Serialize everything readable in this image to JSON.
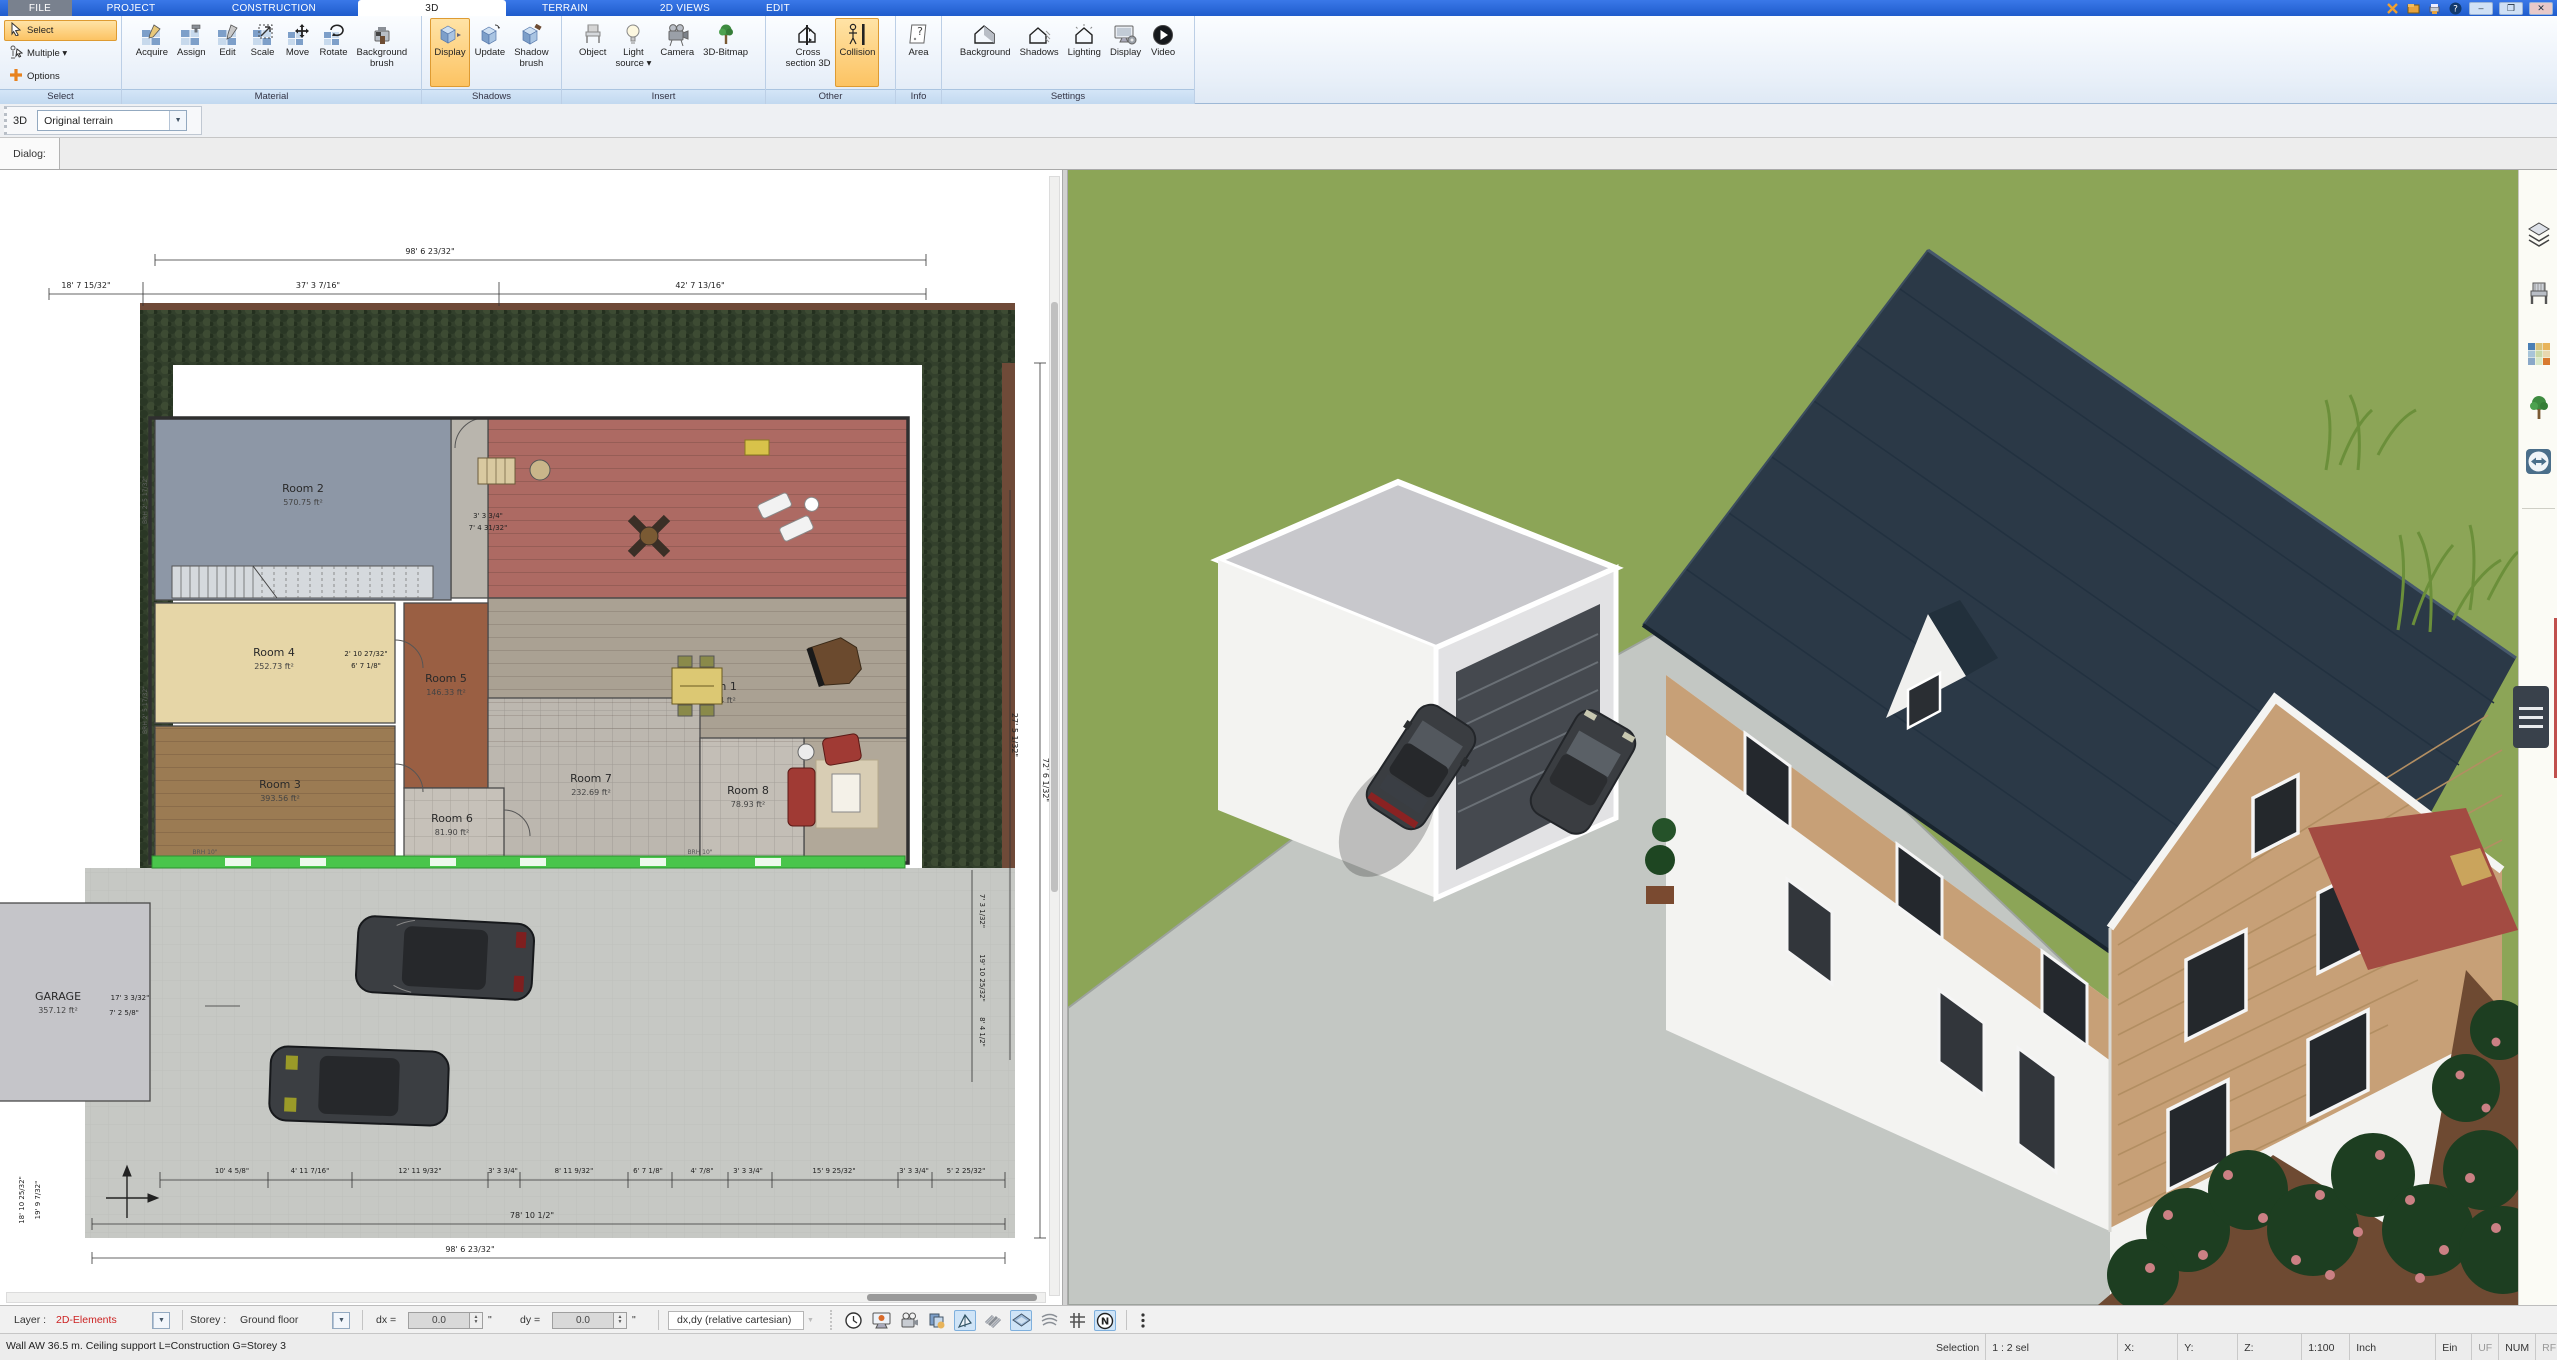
{
  "titlebar": {
    "tabs": [
      "FILE",
      "PROJECT",
      "CONSTRUCTION",
      "3D",
      "TERRAIN",
      "2D VIEWS",
      "EDIT"
    ],
    "active_tab": "3D",
    "window_buttons": {
      "minimize": "–",
      "restore": "❐",
      "close": "✕"
    }
  },
  "ribbon": {
    "select_group": {
      "caption": "Select",
      "select": "Select",
      "multiple": "Multiple ▾",
      "options": "Options"
    },
    "material": {
      "caption": "Material",
      "buttons": [
        "Acquire",
        "Assign",
        "Edit",
        "Scale",
        "Move",
        "Rotate",
        "Background\nbrush"
      ]
    },
    "shadows": {
      "caption": "Shadows",
      "buttons": [
        "Display",
        "Update",
        "Shadow\nbrush"
      ]
    },
    "insert": {
      "caption": "Insert",
      "buttons": [
        "Object",
        "Light\nsource ▾",
        "Camera",
        "3D-Bitmap"
      ]
    },
    "other": {
      "caption": "Other",
      "buttons": [
        "Cross\nsection 3D",
        "Collision"
      ]
    },
    "info": {
      "caption": "Info",
      "buttons": [
        "Area"
      ]
    },
    "settings": {
      "caption": "Settings",
      "buttons": [
        "Background",
        "Shadows",
        "Lighting",
        "Display",
        "Video"
      ]
    }
  },
  "viewbar": {
    "mode_label": "3D",
    "terrain_value": "Original terrain"
  },
  "dialog_label": "Dialog:",
  "plan": {
    "rooms": [
      {
        "name": "",
        "area": "",
        "x": 488,
        "y": 248,
        "w": 420,
        "h": 180,
        "fill": "#ad6a63",
        "lx": 0,
        "ly": 0
      },
      {
        "name": "",
        "area": "",
        "x": 451,
        "y": 248,
        "w": 37,
        "h": 180,
        "fill": "#b9b5ad",
        "lx": 0,
        "ly": 0
      },
      {
        "name": "Room 2",
        "area": "570.75 ft²",
        "x": 155,
        "y": 248,
        "w": 296,
        "h": 182,
        "fill": "#8d97a6",
        "lx": 303,
        "ly": 322
      },
      {
        "name": "Room 1",
        "area": "714.34 ft²",
        "x": 488,
        "y": 428,
        "w": 420,
        "h": 145,
        "fill": "#aaa193",
        "lx": 716,
        "ly": 520
      },
      {
        "name": "",
        "area": "",
        "x": 804,
        "y": 568,
        "w": 104,
        "h": 125,
        "fill": "#b1a899",
        "lx": 0,
        "ly": 0
      },
      {
        "name": "Room 4",
        "area": "252.73 ft²",
        "x": 155,
        "y": 433,
        "w": 240,
        "h": 120,
        "fill": "#e6d6a7",
        "lx": 274,
        "ly": 486
      },
      {
        "name": "Room 5",
        "area": "146.33 ft²",
        "x": 404,
        "y": 433,
        "w": 84,
        "h": 185,
        "fill": "#9a5f43",
        "lx": 446,
        "ly": 512
      },
      {
        "name": "Room 3",
        "area": "393.56 ft²",
        "x": 155,
        "y": 556,
        "w": 240,
        "h": 137,
        "fill": "#9b7b53",
        "lx": 280,
        "ly": 618
      },
      {
        "name": "Room 7",
        "area": "232.69 ft²",
        "x": 488,
        "y": 528,
        "w": 212,
        "h": 165,
        "fill": "#bcb7af",
        "lx": 591,
        "ly": 612
      },
      {
        "name": "Room 8",
        "area": "78.93 ft²",
        "x": 700,
        "y": 568,
        "w": 104,
        "h": 125,
        "fill": "#c3beb6",
        "lx": 748,
        "ly": 624
      },
      {
        "name": "Room 6",
        "area": "81.90 ft²",
        "x": 404,
        "y": 618,
        "w": 100,
        "h": 75,
        "fill": "#c6c1b9",
        "lx": 452,
        "ly": 652
      },
      {
        "name": "GARAGE",
        "area": "357.12 ft²",
        "x": -6,
        "y": 733,
        "w": 156,
        "h": 198,
        "fill": "#c5c5c9",
        "lx": 58,
        "ly": 830
      }
    ],
    "dims": [
      {
        "t": "98' 6 23/32\"",
        "x": 430,
        "y": 84
      },
      {
        "t": "37' 3 7/16\"",
        "x": 318,
        "y": 118
      },
      {
        "t": "42' 7 13/16\"",
        "x": 700,
        "y": 118
      },
      {
        "t": "18' 7 15/32\"",
        "x": 86,
        "y": 118
      },
      {
        "t": "72' 6 1/32\"",
        "x": 1043,
        "y": 610,
        "r": 90
      },
      {
        "t": "27' 5 1/32\"",
        "x": 1012,
        "y": 565,
        "r": 90
      },
      {
        "t": "7' 3 1/32\"",
        "x": 980,
        "y": 741,
        "r": 90,
        "s": 7
      },
      {
        "t": "19' 10 25/32\"",
        "x": 980,
        "y": 808,
        "r": 90,
        "s": 7
      },
      {
        "t": "8' 4 1/2\"",
        "x": 980,
        "y": 862,
        "r": 90,
        "s": 7
      },
      {
        "t": "10' 4 5/8\"",
        "x": 232,
        "y": 1003,
        "s": 7
      },
      {
        "t": "4' 11 7/16\"",
        "x": 310,
        "y": 1003,
        "s": 7
      },
      {
        "t": "12' 11 9/32\"",
        "x": 420,
        "y": 1003,
        "s": 7
      },
      {
        "t": "3' 3 3/4\"",
        "x": 503,
        "y": 1003,
        "s": 7
      },
      {
        "t": "8' 11 9/32\"",
        "x": 574,
        "y": 1003,
        "s": 7
      },
      {
        "t": "6' 7 1/8\"",
        "x": 648,
        "y": 1003,
        "s": 7
      },
      {
        "t": "4' 7/8\"",
        "x": 702,
        "y": 1003,
        "s": 7
      },
      {
        "t": "3' 3 3/4\"",
        "x": 748,
        "y": 1003,
        "s": 7
      },
      {
        "t": "15' 9 25/32\"",
        "x": 834,
        "y": 1003,
        "s": 7
      },
      {
        "t": "3' 3 3/4\"",
        "x": 914,
        "y": 1003,
        "s": 7
      },
      {
        "t": "5' 2 25/32\"",
        "x": 966,
        "y": 1003,
        "s": 7
      },
      {
        "t": "78' 10 1/2\"",
        "x": 532,
        "y": 1048
      },
      {
        "t": "98' 6 23/32\"",
        "x": 470,
        "y": 1082
      },
      {
        "t": "18' 10 25/32\"",
        "x": 24,
        "y": 1030,
        "r": -90,
        "s": 7
      },
      {
        "t": "19' 9 7/32\"",
        "x": 40,
        "y": 1030,
        "r": -90,
        "s": 7
      },
      {
        "t": "17' 3 3/32\"",
        "x": 130,
        "y": 830,
        "s": 7
      },
      {
        "t": "7' 2 5/8\"",
        "x": 124,
        "y": 845,
        "s": 7
      },
      {
        "t": "3' 3 3/4\"",
        "x": 488,
        "y": 348,
        "s": 7
      },
      {
        "t": "7' 4 31/32\"",
        "x": 488,
        "y": 360,
        "s": 7
      },
      {
        "t": "2' 10 27/32\"",
        "x": 366,
        "y": 486,
        "s": 7
      },
      {
        "t": "6' 7 1/8\"",
        "x": 366,
        "y": 498,
        "s": 7
      },
      {
        "t": "BRH 2' 5 17/32\"",
        "x": 147,
        "y": 330,
        "r": -90,
        "s": 6,
        "c": "#666"
      },
      {
        "t": "BRH 2' 5 17/32\"",
        "x": 147,
        "y": 540,
        "r": -90,
        "s": 6,
        "c": "#666"
      },
      {
        "t": "BRH 10\"",
        "x": 205,
        "y": 684,
        "s": 6,
        "c": "#555"
      },
      {
        "t": "BRH 10\"",
        "x": 700,
        "y": 684,
        "s": 6,
        "c": "#555"
      }
    ]
  },
  "scene": {
    "colors": {
      "lawn": "#8ca557",
      "lawn_light": "#9fb264",
      "driveway": "#c3c7c3",
      "roof": "#2b3947",
      "wood": "#c7a077",
      "wall": "#f3f3f1",
      "garage_top": "#c8c8cc",
      "garage_door": "#45494f",
      "hedge": "#1d3e21",
      "flower": "#cb8084",
      "mulch": "#6e4a32",
      "terrace": "#a34b42",
      "car": "#3a3d41"
    }
  },
  "side_toolbar": {
    "icons": [
      "layer-display",
      "furniture-catalog",
      "materials-catalog",
      "plants-catalog",
      "remote-connect"
    ]
  },
  "toolbar": {
    "layer_label": "Layer :",
    "layer_value": "2D-Elements",
    "storey_label": "Storey :",
    "storey_value": "Ground floor",
    "dx_label": "dx =",
    "dx_value": "0.0",
    "dy_label": "dy =",
    "dy_value": "0.0",
    "unit_mark": "\"",
    "mode_box": "dx,dy (relative cartesian)"
  },
  "statusbar": {
    "message": "Wall AW 36.5 m. Ceiling support L=Construction G=Storey 3",
    "selection_label": "Selection",
    "selection_value": "1 : 2 sel",
    "x_label": "X:",
    "y_label": "Y:",
    "z_label": "Z:",
    "scale": "1:100",
    "unit": "Inch",
    "ein": "Ein",
    "uf": "UF",
    "num": "NUM",
    "rf": "RF"
  }
}
